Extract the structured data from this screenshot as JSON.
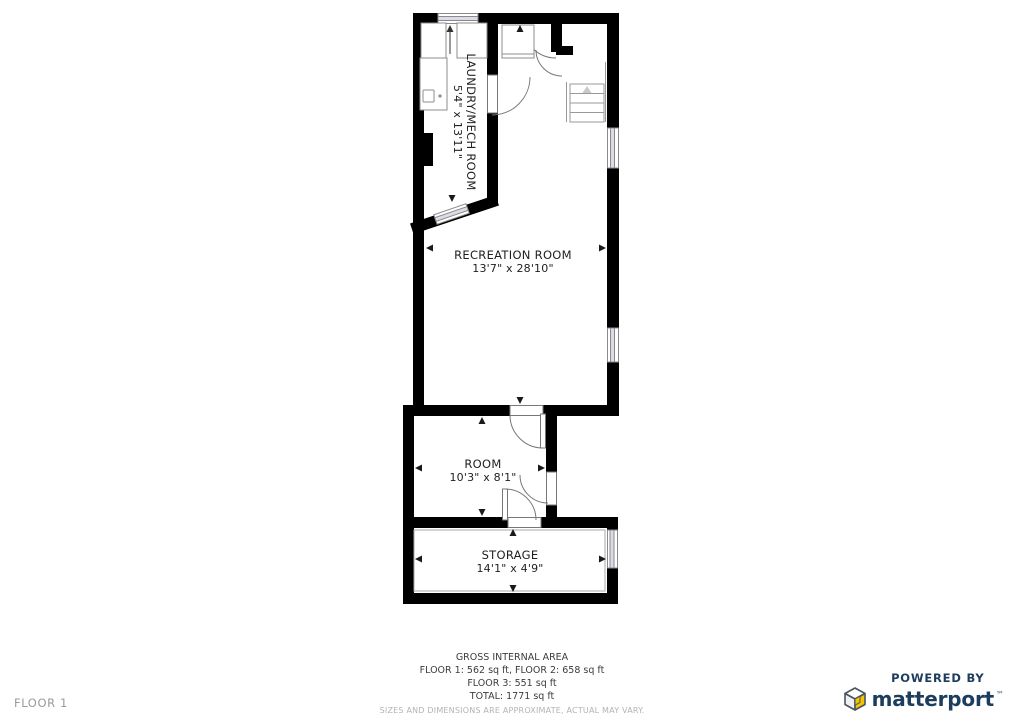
{
  "floor_tag": "FLOOR 1",
  "rooms": {
    "laundry": {
      "name": "LAUNDRY/MECH ROOM",
      "dims": "5'4\" x 13'11\""
    },
    "recreation": {
      "name": "RECREATION ROOM",
      "dims": "13'7\" x 28'10\""
    },
    "room": {
      "name": "ROOM",
      "dims": "10'3\" x 8'1\""
    },
    "storage": {
      "name": "STORAGE",
      "dims": "14'1\" x 4'9\""
    }
  },
  "footer": {
    "title": "GROSS INTERNAL AREA",
    "line1": "FLOOR 1: 562 sq ft, FLOOR 2: 658 sq ft",
    "line2": "FLOOR 3: 551 sq ft",
    "line3": "TOTAL: 1771 sq ft",
    "disclaimer": "SIZES AND DIMENSIONS ARE APPROXIMATE, ACTUAL MAY VARY."
  },
  "branding": {
    "powered_by": "POWERED BY",
    "brand": "matterport",
    "trademark": "™",
    "brand_color": "#1d3d5e",
    "cube_yellow": "#f2c500",
    "cube_outline": "#4a5560"
  },
  "colors": {
    "wall": "#000000",
    "label_text": "#1f1f1f",
    "muted_text": "#9a9a9a",
    "disclaimer_text": "#b3b3b3",
    "window_glass": "#dcdce8"
  },
  "icons": {
    "stairs_up_arrow": "stairs-up-arrow",
    "dimension_arrows": "dimension-arrowheads"
  }
}
